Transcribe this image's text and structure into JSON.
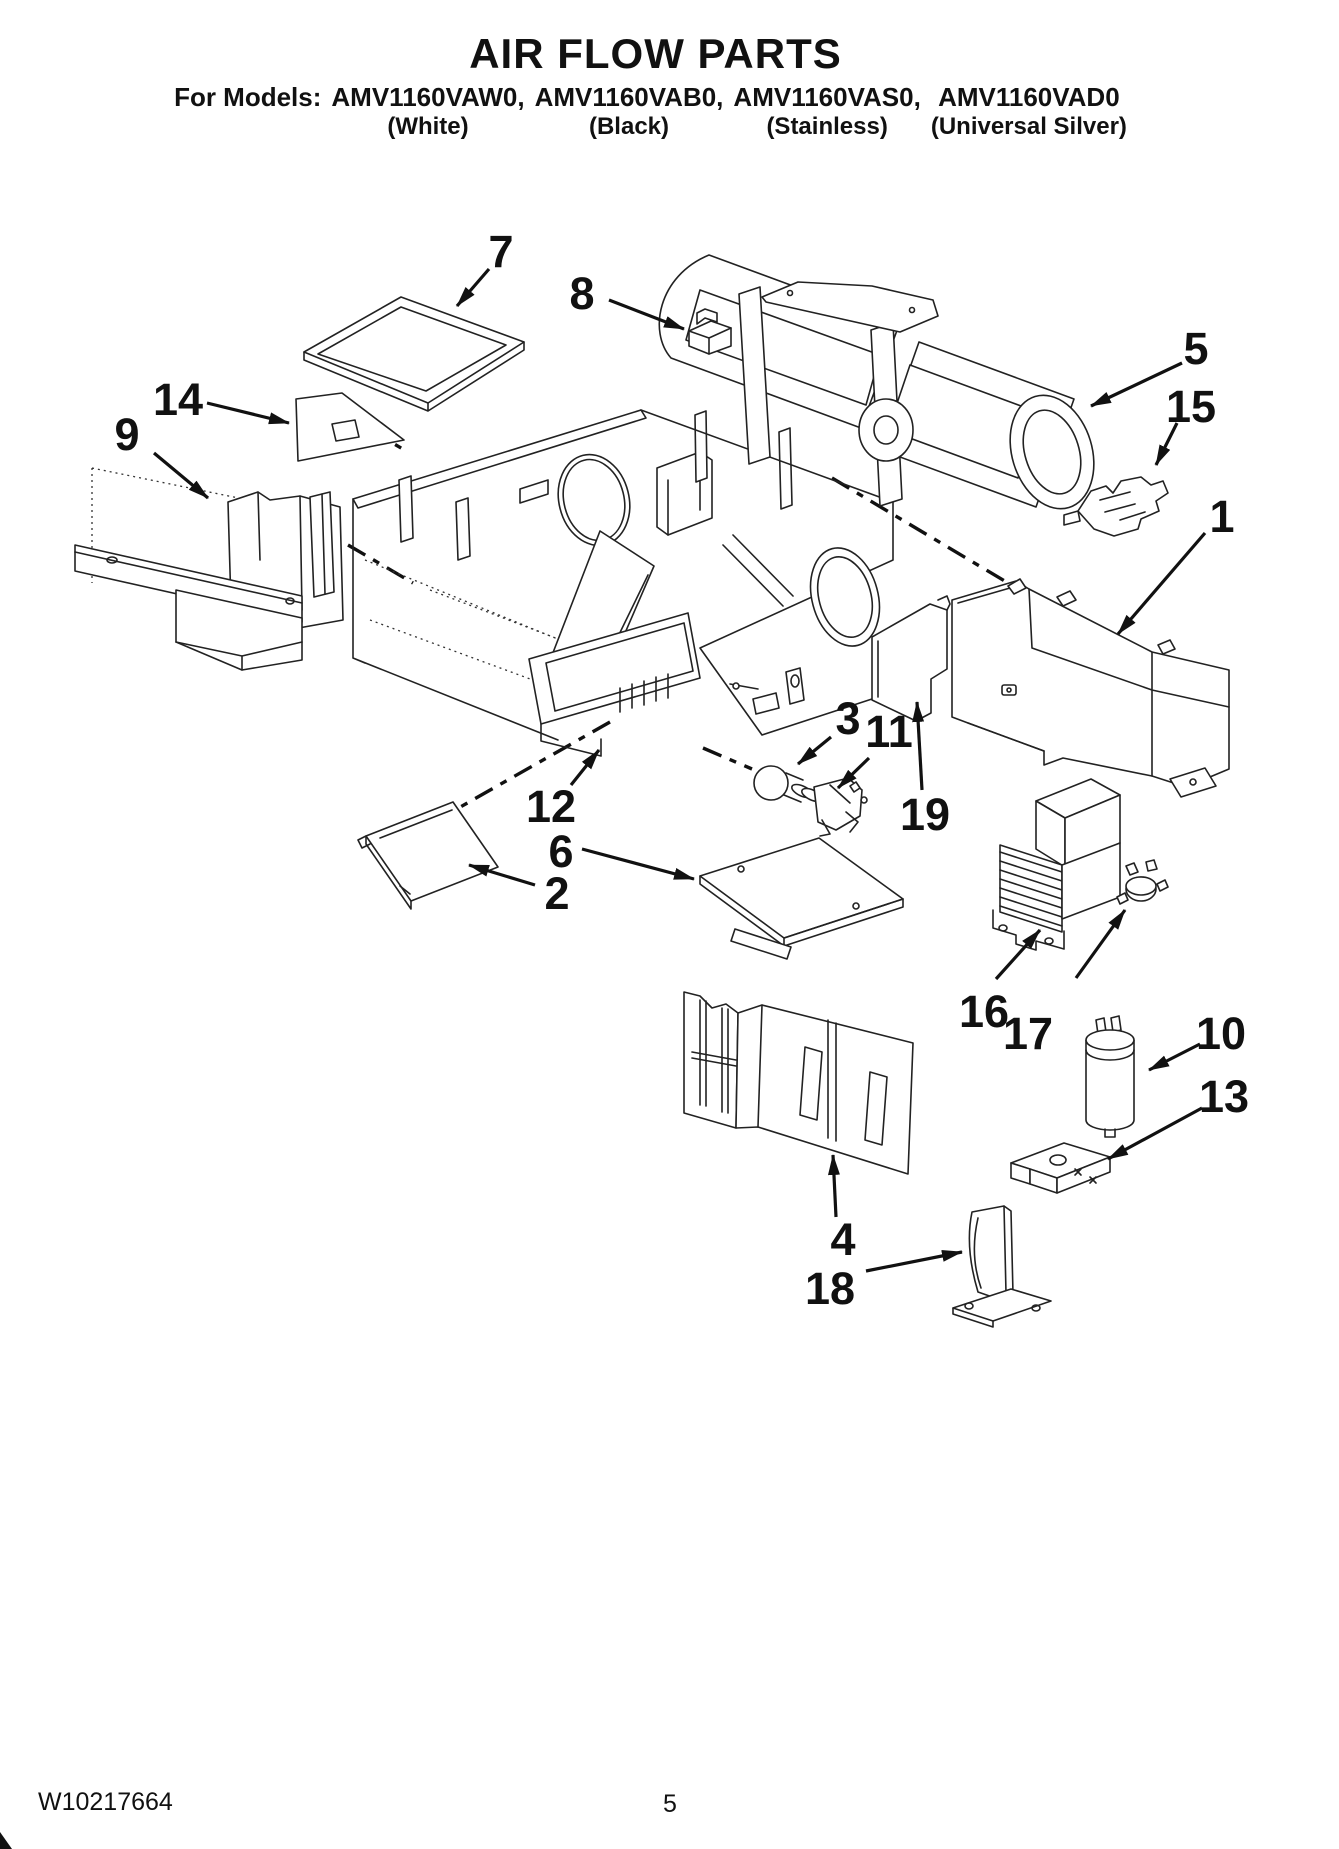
{
  "header": {
    "title": "AIR FLOW PARTS",
    "models_prefix": "For Models:",
    "models": [
      {
        "name": "AMV1160VAW0,",
        "color": "(White)"
      },
      {
        "name": "AMV1160VAB0,",
        "color": "(Black)"
      },
      {
        "name": "AMV1160VAS0,",
        "color": "(Stainless)"
      },
      {
        "name": "AMV1160VAD0",
        "color": "(Universal Silver)"
      }
    ]
  },
  "diagram": {
    "type": "exploded-parts-diagram",
    "ink_color": "#1a1a1a",
    "paper_color": "#ffffff",
    "callouts": [
      {
        "label": "1"
      },
      {
        "label": "2"
      },
      {
        "label": "3"
      },
      {
        "label": "4"
      },
      {
        "label": "5"
      },
      {
        "label": "6"
      },
      {
        "label": "7"
      },
      {
        "label": "8"
      },
      {
        "label": "9"
      },
      {
        "label": "10"
      },
      {
        "label": "11"
      },
      {
        "label": "12"
      },
      {
        "label": "13"
      },
      {
        "label": "14"
      },
      {
        "label": "15"
      },
      {
        "label": "16"
      },
      {
        "label": "17"
      },
      {
        "label": "18"
      },
      {
        "label": "19"
      }
    ]
  },
  "footer": {
    "doc_number": "W10217664",
    "page_number": "5"
  }
}
